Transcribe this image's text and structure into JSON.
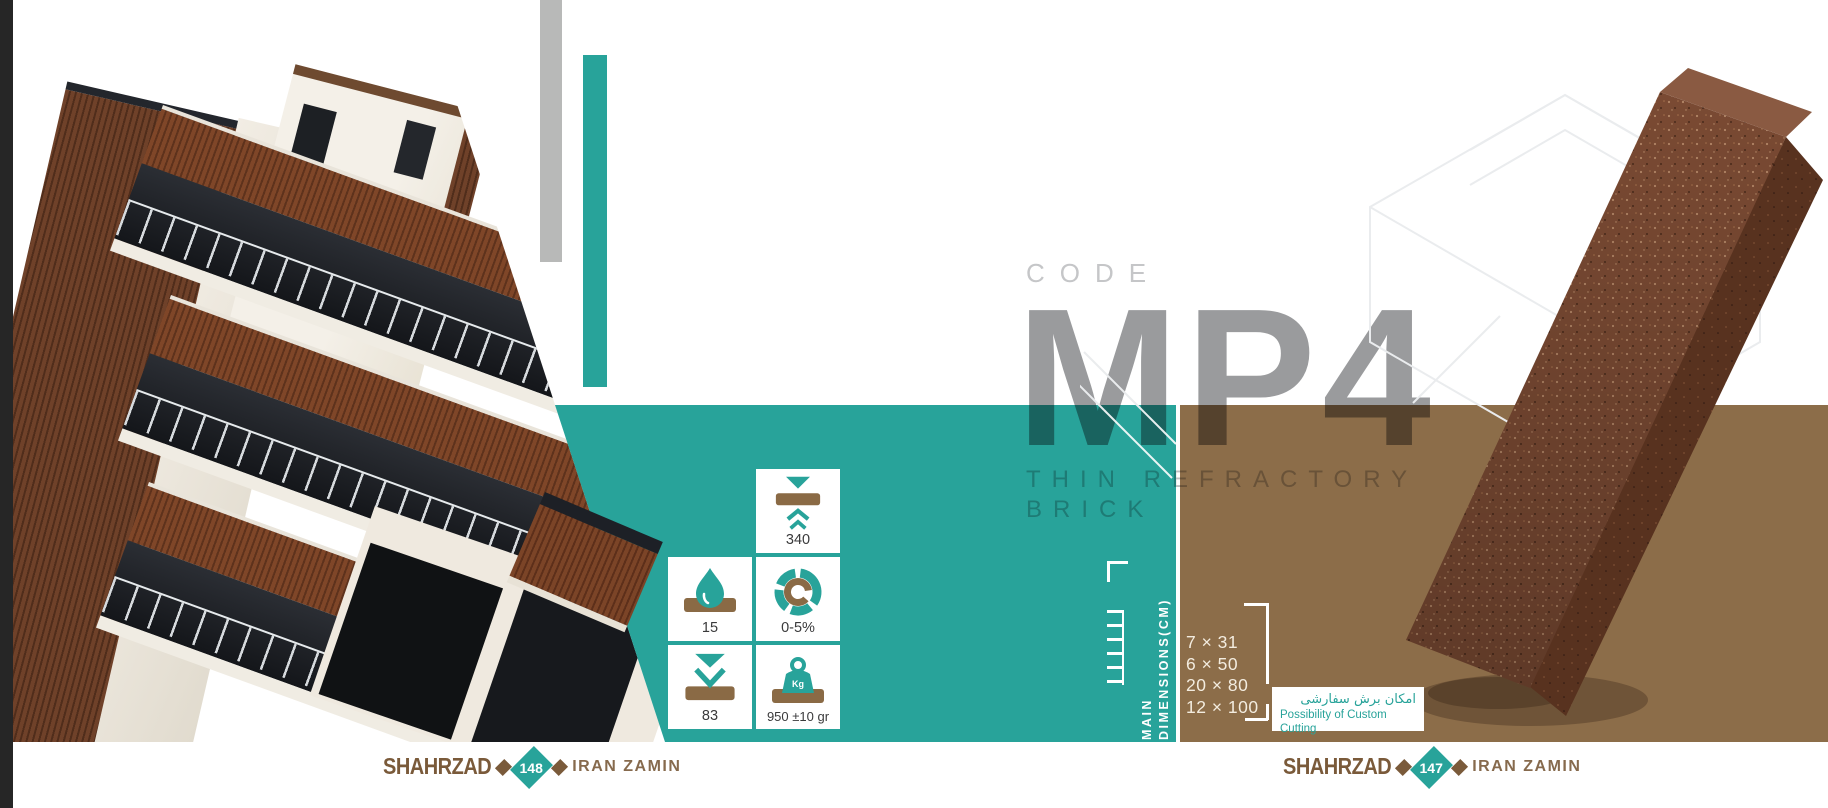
{
  "colors": {
    "teal": "#28a39a",
    "brown": "#8c6d49",
    "brick-brown": "#8a6a45",
    "logo-brown": "#7a5a3a",
    "gray-bar": "#b8b9b8",
    "mp4-gray": "#9a9b9d",
    "dark-strip": "#262626",
    "tile-text": "#3a3a3b"
  },
  "code_block": {
    "label": "CODE",
    "value": "MP4",
    "subtitle_line1": "THIN REFRACTORY",
    "subtitle_line2": "BRICK"
  },
  "specs": [
    {
      "name": "compressive-strength",
      "icon": "compression-icon",
      "value": "340"
    },
    {
      "name": "water-absorption",
      "icon": "water-drop-icon",
      "value": "15"
    },
    {
      "name": "porosity",
      "icon": "segmented-ring-icon",
      "value": "0-5%"
    },
    {
      "name": "impact-resistance",
      "icon": "impact-arrow-icon",
      "value": "83"
    },
    {
      "name": "unit-weight",
      "icon": "weight-icon",
      "value": "950 ±10 gr"
    }
  ],
  "dimensions": {
    "heading_word1": "MAIN",
    "heading_word2": "DIMENSIONS(CM)",
    "sizes": [
      "7 × 31",
      "6 × 50",
      "20 × 80",
      "12 × 100"
    ]
  },
  "custom_cutting": {
    "fa": "امکان برش سفارشی",
    "en": "Possibility of Custom Cutting"
  },
  "footer_left": {
    "brand_left": "SHAHRZAD",
    "page_number": "148",
    "brand_right": "IRAN ZAMIN"
  },
  "footer_right": {
    "brand_left": "SHAHRZAD",
    "page_number": "147",
    "brand_right": "IRAN ZAMIN"
  }
}
